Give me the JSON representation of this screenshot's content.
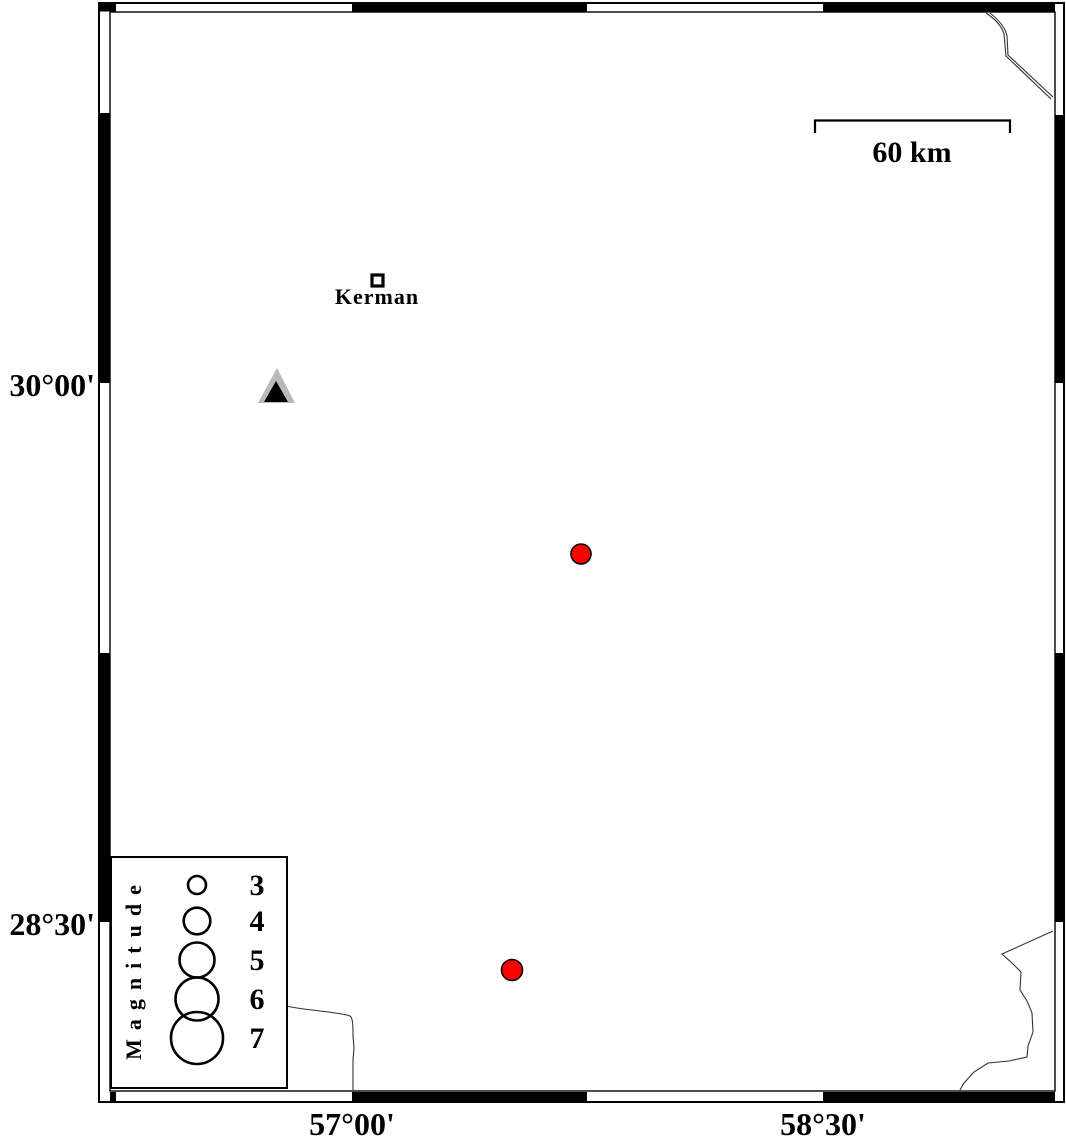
{
  "figure": {
    "kind": "seismicity map with fancy alternating frame",
    "background": "#ffffff"
  },
  "frame": {
    "style": "alternating black/white border segments",
    "left_labels": [
      {
        "text": "30°00'",
        "y": 383
      },
      {
        "text": "28°30'",
        "y": 922
      }
    ],
    "bottom_labels": [
      {
        "text": "57°00'",
        "x": 352
      },
      {
        "text": "58°30'",
        "x": 823
      }
    ]
  },
  "scale_bar": {
    "label": "60 km",
    "x1": 815,
    "x2": 1010,
    "y": 121
  },
  "city": {
    "label": "Kerman",
    "marker": "open-square",
    "x": 377,
    "y": 280,
    "approx_lon": "57.08 E",
    "approx_lat": "30.28 N"
  },
  "station": {
    "marker": "triangle",
    "x": 277,
    "y": 390,
    "fill": "#b9b9b9",
    "inner_fill": "#000000",
    "approx_lon": "56.76 E",
    "approx_lat": "30.00 N"
  },
  "earthquakes": [
    {
      "x": 581,
      "y": 554,
      "radius_px": 10,
      "color": "#ff0000",
      "approx_lon": "57.73 E",
      "approx_lat": "29.52 N",
      "approx_magnitude": 3.2
    },
    {
      "x": 512,
      "y": 970,
      "radius_px": 10.5,
      "color": "#ff0000",
      "approx_lon": "57.51 E",
      "approx_lat": "28.37 N",
      "approx_magnitude": 3.3
    }
  ],
  "legend": {
    "title": "Magnitude",
    "cx": 197,
    "rows_y": [
      885,
      921,
      960,
      999,
      1038
    ],
    "entries": [
      {
        "label": "3",
        "radius_px": 9
      },
      {
        "label": "4",
        "radius_px": 13.3
      },
      {
        "label": "5",
        "radius_px": 17.5
      },
      {
        "label": "6",
        "radius_px": 21.5
      },
      {
        "label": "7",
        "radius_px": 26
      }
    ]
  },
  "colors": {
    "earthquake": "#ff0000",
    "station_fill": "#b9b9b9",
    "frame": "#000000",
    "coastline": "#333333",
    "background": "#ffffff"
  }
}
